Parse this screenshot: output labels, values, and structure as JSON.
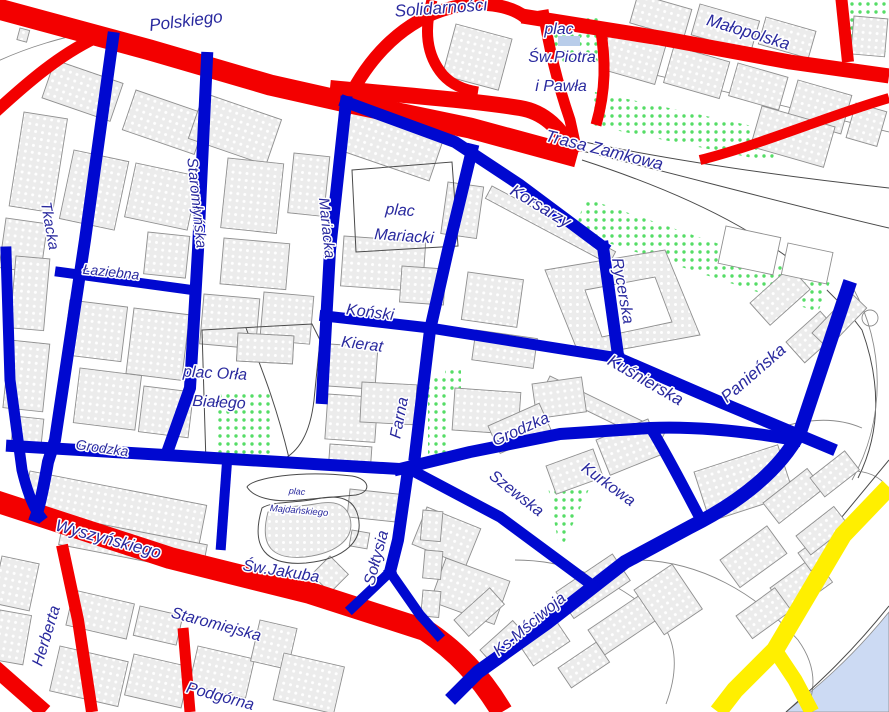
{
  "map": {
    "colors": {
      "major_road": "#f30000",
      "minor_street": "#0008d0",
      "scenic_route": "#ffef00",
      "water": "#ccdaf3",
      "pond": "#b9cdea",
      "label_text": "#29299e",
      "building_fill": "#ececec",
      "building_outline": "#8f8f8f",
      "park_dot": "#55dd66"
    },
    "labels": [
      {
        "id": "polskiego",
        "text": "Polskiego",
        "x": 186,
        "y": 22,
        "r": -7,
        "s": 17
      },
      {
        "id": "solidarnosci",
        "text": "Solidarności",
        "x": 441,
        "y": 9,
        "r": -4,
        "s": 17
      },
      {
        "id": "plac-sw-piotra-1",
        "text": "plac",
        "x": 559,
        "y": 30,
        "r": 0,
        "s": 16
      },
      {
        "id": "plac-sw-piotra-2",
        "text": "Św.Piotra",
        "x": 562,
        "y": 58,
        "r": 0,
        "s": 16
      },
      {
        "id": "plac-sw-piotra-3",
        "text": "i Pawła",
        "x": 561,
        "y": 87,
        "r": 0,
        "s": 16
      },
      {
        "id": "malopolska",
        "text": "Małopolska",
        "x": 748,
        "y": 33,
        "r": 17,
        "s": 17
      },
      {
        "id": "trasa-zamkowa",
        "text": "Trasa Zamkowa",
        "x": 604,
        "y": 151,
        "r": 14,
        "s": 17
      },
      {
        "id": "korsarzy",
        "text": "Korsarzy",
        "x": 540,
        "y": 207,
        "r": 31,
        "s": 17
      },
      {
        "id": "rycerska",
        "text": "Rycerska",
        "x": 622,
        "y": 291,
        "r": 80,
        "s": 16
      },
      {
        "id": "kusnierska",
        "text": "Kuśnierska",
        "x": 645,
        "y": 381,
        "r": 30,
        "s": 17
      },
      {
        "id": "panienska",
        "text": "Panieńska",
        "x": 754,
        "y": 374,
        "r": -41,
        "s": 17
      },
      {
        "id": "tkacka",
        "text": "Tkacka",
        "x": 49,
        "y": 226,
        "r": 80,
        "s": 15
      },
      {
        "id": "staromlynska",
        "text": "Staromłyńska",
        "x": 196,
        "y": 203,
        "r": 84,
        "s": 15
      },
      {
        "id": "mariacka",
        "text": "Mariacka",
        "x": 326,
        "y": 228,
        "r": 84,
        "s": 15
      },
      {
        "id": "laziebna",
        "text": "Łaziebna",
        "x": 111,
        "y": 273,
        "r": 6,
        "s": 14
      },
      {
        "id": "plac-mariacki-1",
        "text": "plac",
        "x": 400,
        "y": 211,
        "r": 4,
        "s": 16
      },
      {
        "id": "plac-mariacki-2",
        "text": "Mariacki",
        "x": 404,
        "y": 237,
        "r": 4,
        "s": 16
      },
      {
        "id": "konski",
        "text": "Koński",
        "x": 370,
        "y": 313,
        "r": 7,
        "s": 16
      },
      {
        "id": "kierat",
        "text": "Kierat",
        "x": 362,
        "y": 345,
        "r": 7,
        "s": 16
      },
      {
        "id": "plac-orla-1",
        "text": "plac Orła",
        "x": 215,
        "y": 374,
        "r": 3,
        "s": 16
      },
      {
        "id": "plac-orla-2",
        "text": "Białego",
        "x": 219,
        "y": 403,
        "r": 3,
        "s": 16
      },
      {
        "id": "grodzka-w",
        "text": "Grodzka",
        "x": 102,
        "y": 449,
        "r": 8,
        "s": 14
      },
      {
        "id": "farna",
        "text": "Farna",
        "x": 400,
        "y": 418,
        "r": -79,
        "s": 16
      },
      {
        "id": "grodzka-e",
        "text": "Grodzka",
        "x": 521,
        "y": 430,
        "r": -24,
        "s": 16
      },
      {
        "id": "szewska",
        "text": "Szewska",
        "x": 516,
        "y": 494,
        "r": 38,
        "s": 16
      },
      {
        "id": "kurkowa",
        "text": "Kurkowa",
        "x": 608,
        "y": 485,
        "r": 36,
        "s": 16
      },
      {
        "id": "soltysia",
        "text": "Sołtysia",
        "x": 377,
        "y": 558,
        "r": -75,
        "s": 16
      },
      {
        "id": "sw-jakuba",
        "text": "Św.Jakuba",
        "x": 281,
        "y": 572,
        "r": 9,
        "s": 16
      },
      {
        "id": "plac-majdanskiego-1",
        "text": "plac",
        "x": 297,
        "y": 492,
        "r": 5,
        "s": 9
      },
      {
        "id": "plac-majdanskiego-2",
        "text": "Majdańskiego",
        "x": 299,
        "y": 511,
        "r": 5,
        "s": 9.5
      },
      {
        "id": "wyszynskiego",
        "text": "Wyszyńskiego",
        "x": 108,
        "y": 540,
        "r": 15,
        "s": 17
      },
      {
        "id": "staromiejska",
        "text": "Staromiejska",
        "x": 216,
        "y": 625,
        "r": 15,
        "s": 16
      },
      {
        "id": "podgorna",
        "text": "Podgórna",
        "x": 220,
        "y": 697,
        "r": 15,
        "s": 16
      },
      {
        "id": "herberta",
        "text": "Herberta",
        "x": 47,
        "y": 636,
        "r": -73,
        "s": 16
      },
      {
        "id": "ks-msciwoja",
        "text": "Ks.Mściwoja",
        "x": 530,
        "y": 625,
        "r": -40,
        "s": 16
      }
    ]
  }
}
